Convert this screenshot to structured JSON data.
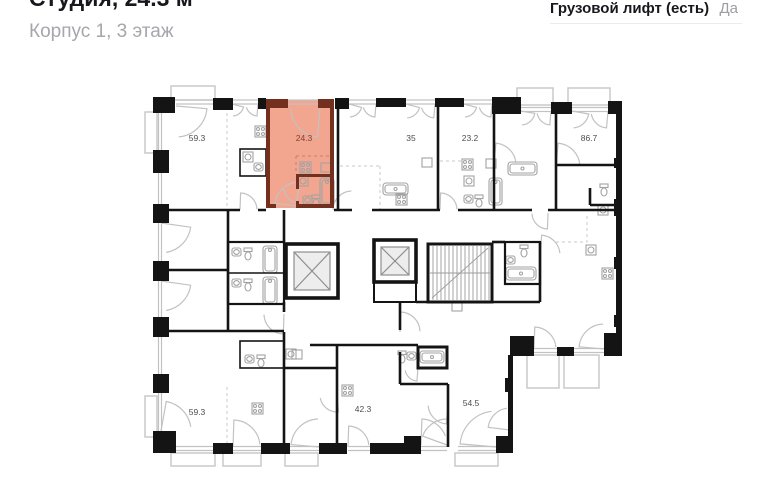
{
  "header": {
    "title": "Студия, 24.3 м²",
    "subtitle": "Корпус 1, 3 этаж"
  },
  "info_panel": {
    "row": {
      "label": "Грузовой лифт (есть)",
      "value": "Да"
    }
  },
  "floor_plan": {
    "selected_unit_area": "24.3",
    "colors": {
      "highlight_fill": "#F2A58F",
      "highlight_wall": "#74301F",
      "wall": "#141414",
      "fixture": "#A3A3A3"
    },
    "units": [
      {
        "label": "59.3",
        "highlighted": false
      },
      {
        "label": "24.3",
        "highlighted": true
      },
      {
        "label": "35",
        "highlighted": false
      },
      {
        "label": "23.2",
        "highlighted": false
      },
      {
        "label": "86.7",
        "highlighted": false
      },
      {
        "label": "59.3",
        "highlighted": false
      },
      {
        "label": "42.3",
        "highlighted": false
      },
      {
        "label": "54.5",
        "highlighted": false
      }
    ]
  }
}
